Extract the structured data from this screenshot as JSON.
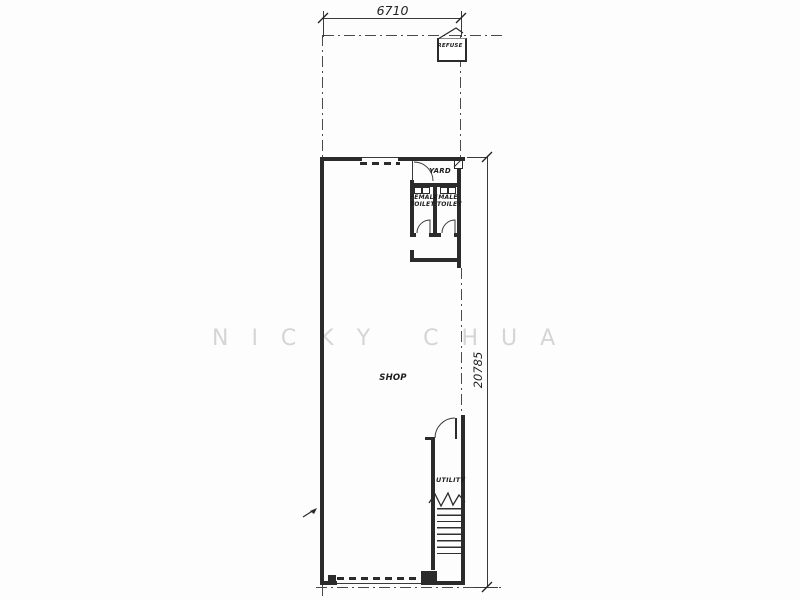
{
  "drawing": {
    "title": "shop-unit-floor-plan",
    "dimensions": {
      "top_width": "6710",
      "right_height": "20785"
    },
    "rooms": {
      "refuse": "REFUSE",
      "yard": "YARD",
      "female_toilet_line1": "FEMALE",
      "female_toilet_line2": "TOILET",
      "male_toilet_line1": "MALE",
      "male_toilet_line2": "TOILET",
      "shop": "SHOP",
      "utility": "UTILITY"
    },
    "watermark": "N I C K Y   C H U A",
    "colors": {
      "line": "#2b2b2b",
      "boundary_line": "#4a4a4a",
      "watermark": "#d5d5d5",
      "paper": "#fdfdfd"
    }
  }
}
